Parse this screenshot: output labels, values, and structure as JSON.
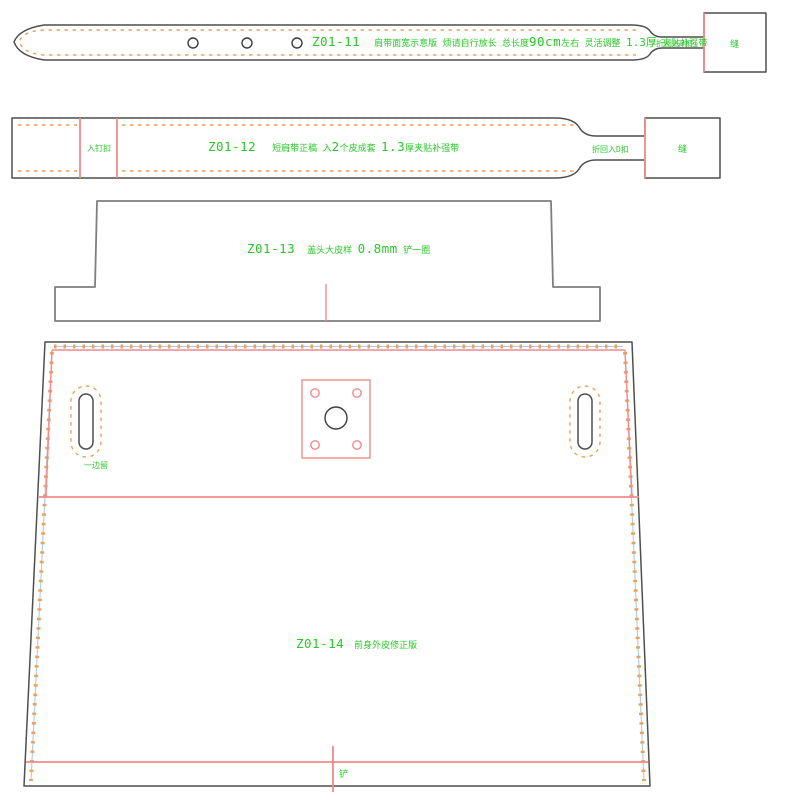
{
  "colors": {
    "outline": "#4f4f4f",
    "outline2": "#7f7f7f",
    "red": "#f28a8a",
    "green": "#28c828",
    "orange": "#e8a45e",
    "blue": "#aecbe8",
    "bg": "#ffffff"
  },
  "pieces": {
    "belt": {
      "id": "Z01-11",
      "note_a": "肩带面宽示意版  烦请自行放长  总长度",
      "note_size": "90cm",
      "note_b": "左右  灵活调整 ",
      "note_thick": "1.3厚",
      "note_c": " 夹贴补强带",
      "fold_label": "折回入D扣",
      "end_label": "缝"
    },
    "strap": {
      "id": "Z01-12",
      "note_a": "短肩带正稿   入",
      "note_num": "2",
      "note_b": "个皮成套 ",
      "note_thick": "1.3",
      "note_c": "厚夹贴补强带",
      "left_box_label": "入钉扣",
      "fold_label": "折回入D扣",
      "end_label": "缝"
    },
    "flap": {
      "id": "Z01-13",
      "note_a": "盖头大皮样 ",
      "note_size": "0.8mm",
      "note_b": " 铲一圈"
    },
    "body": {
      "id": "Z01-14",
      "note": "前身外皮修正版",
      "slot_label": "一边留",
      "bottom_label": "铲"
    }
  }
}
